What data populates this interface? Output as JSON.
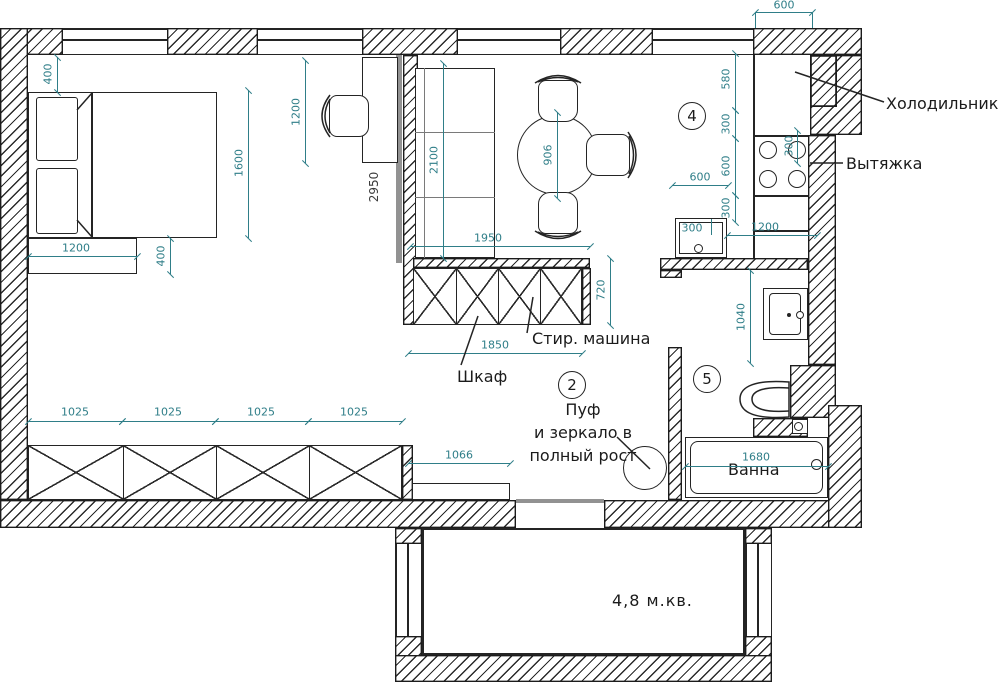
{
  "drawing": {
    "labels": {
      "refrigerator": "Холодильник",
      "hood": "Вытяжка",
      "washing_machine": "Стир. машина",
      "wardrobe": "Шкаф",
      "pouf_line1": "Пуф",
      "pouf_line2": "и зеркало в",
      "pouf_line3": "полный рост",
      "bath": "Ванна",
      "balcony_area": "4,8 м.кв."
    },
    "room_numbers": {
      "hall": "2",
      "kitchen": "4",
      "bathroom": "5"
    },
    "dimensions": {
      "bed_wall_offset": "400",
      "bed_length": "1600",
      "desk_length": "1200",
      "dresser_width": "1200",
      "dresser_depth": "400",
      "corridor_wall": "2950",
      "kitchen_cabinet": "2100",
      "table_diameter": "906",
      "wardrobe_run_top": "1950",
      "wardrobe_depth": "720",
      "wardrobe_width": "1850",
      "closet_sections": [
        "1025",
        "1025",
        "1025",
        "1025"
      ],
      "bench_width": "1066",
      "fridge_width_top": "600",
      "fridge_depth": "580",
      "gap_fridge_cooktop": "300",
      "cooktop_width": "600",
      "gap_cooktop_counter": "300",
      "sink_width": "600",
      "sink_bowl": "300",
      "cooktop_offset": "300",
      "counter_run": "1200",
      "washbasin_run": "1040",
      "bath_length": "1680"
    },
    "colors": {
      "dimension": "#2f7e88",
      "line": "#1c1c1c"
    }
  }
}
